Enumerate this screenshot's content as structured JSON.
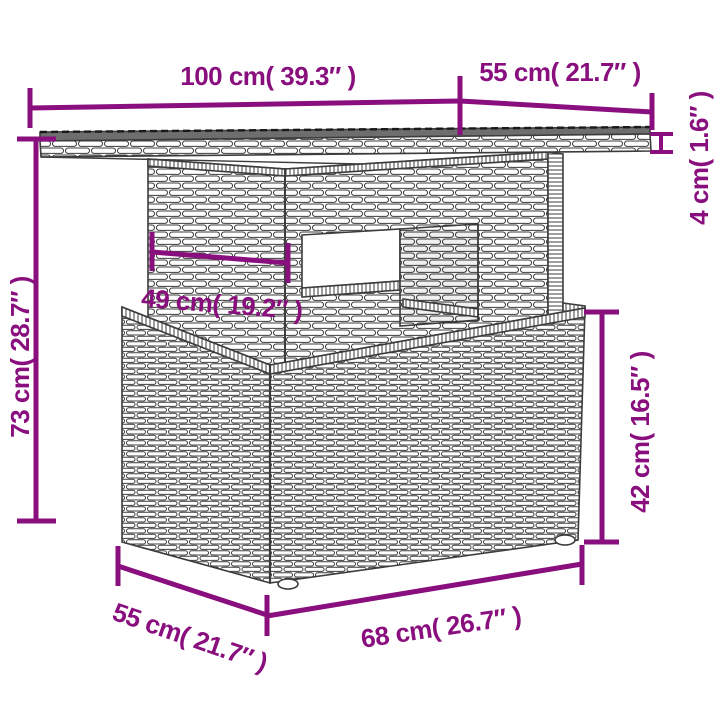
{
  "diagram": {
    "kind": "furniture-dimension-diagram",
    "colors": {
      "accent": "#8a0f7e",
      "outline": "#3c3c3c",
      "glass": "#6e6e6e",
      "background": "#ffffff"
    },
    "dimensions": {
      "table_width": {
        "label": "100 cm( 39.3″ )"
      },
      "table_depth": {
        "label": "55 cm( 21.7″ )"
      },
      "tabletop_thickness": {
        "label": "4 cm( 1.6″ )"
      },
      "table_height": {
        "label": "73 cm( 28.7″ )"
      },
      "pedestal_width": {
        "label": "49 cm( 19.2″ )"
      },
      "base_height": {
        "label": "42 cm( 16.5″ )"
      },
      "base_depth": {
        "label": "55 cm( 21.7″ )"
      },
      "base_width": {
        "label": "68 cm( 26.7″ )"
      }
    }
  }
}
